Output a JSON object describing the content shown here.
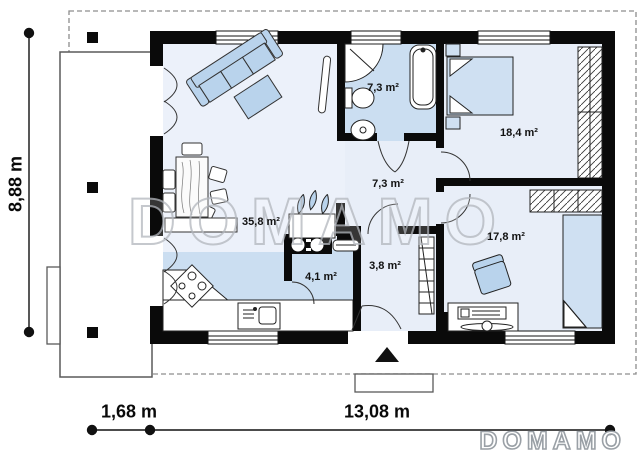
{
  "floor_plan": {
    "watermark_text": "DOMAMO",
    "brand_logo_text": "DOMAMO",
    "rooms": [
      {
        "name": "living-dining-room",
        "area": "35,8 m²"
      },
      {
        "name": "bathroom",
        "area": "7,3 m²"
      },
      {
        "name": "hallway",
        "area": "7,3 m²"
      },
      {
        "name": "main-bedroom",
        "area": "18,4 m²"
      },
      {
        "name": "second-bedroom",
        "area": "17,8 m²"
      },
      {
        "name": "utility-room",
        "area": "4,1 m²"
      },
      {
        "name": "entry-vestibule",
        "area": "3,8 m²"
      }
    ],
    "dimensions": {
      "house_depth": "8,88 m",
      "terrace_width": "1,68 m",
      "house_width": "13,08 m"
    },
    "colors": {
      "wall": "#0a0a0a",
      "room_light": "#ecf1fa",
      "room_medium": "#cbdef1",
      "furniture_blue": "#b9d3ec",
      "bed_blue": "#cfe0f2"
    }
  }
}
